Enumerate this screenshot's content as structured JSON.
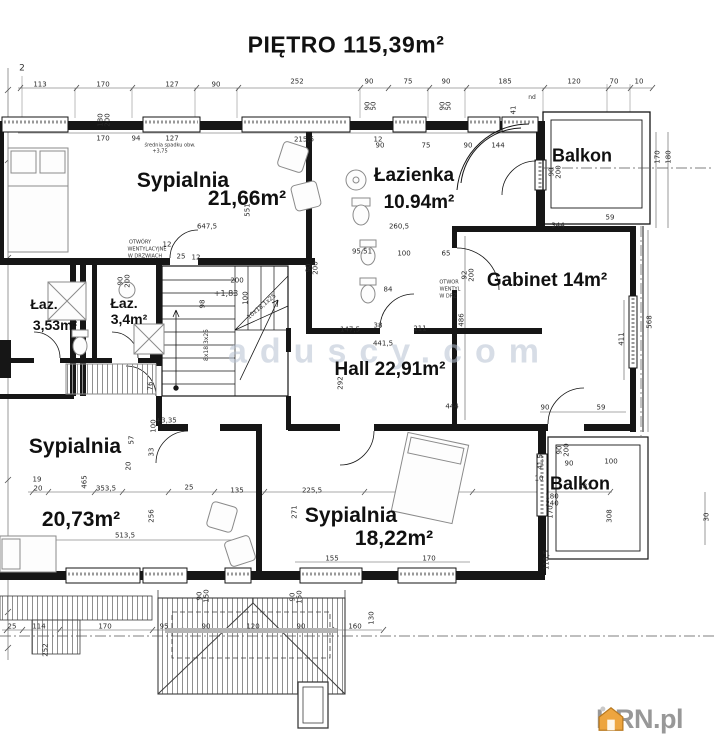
{
  "title": "PIĘTRO 115,39m²",
  "watermark": "aduscy.com",
  "logo": {
    "text": "KRN.pl"
  },
  "colors": {
    "line": "#161616",
    "watermark_blue": "#b7c2d3",
    "logo_orange": "#eda53f",
    "logo_gray": "#989898"
  },
  "room_labels": [
    {
      "id": "sypialnia-1",
      "text": "Sypialnia",
      "x": 183,
      "y": 181,
      "size": 21
    },
    {
      "id": "sypialnia-1-area",
      "text": "21,66m²",
      "x": 247,
      "y": 199,
      "size": 21
    },
    {
      "id": "lazienka",
      "text": "Łazienka",
      "x": 414,
      "y": 176,
      "size": 19
    },
    {
      "id": "lazienka-area",
      "text": "10.94m²",
      "x": 419,
      "y": 203,
      "size": 19
    },
    {
      "id": "balkon-1",
      "text": "Balkon",
      "x": 582,
      "y": 156,
      "size": 18
    },
    {
      "id": "gabinet",
      "text": "Gabinet 14m²",
      "x": 547,
      "y": 281,
      "size": 19
    },
    {
      "id": "laz-1",
      "text": "Łaz.",
      "x": 44,
      "y": 304,
      "size": 14
    },
    {
      "id": "laz-1-area",
      "text": "3,53m²",
      "x": 55,
      "y": 325,
      "size": 14
    },
    {
      "id": "laz-2",
      "text": "Łaz.",
      "x": 124,
      "y": 303,
      "size": 14
    },
    {
      "id": "laz-2-area",
      "text": "3,4m²",
      "x": 129,
      "y": 319,
      "size": 14
    },
    {
      "id": "hall",
      "text": "Hall 22,91m²",
      "x": 390,
      "y": 370,
      "size": 19
    },
    {
      "id": "sypialnia-2",
      "text": "Sypialnia",
      "x": 75,
      "y": 447,
      "size": 21
    },
    {
      "id": "sypialnia-2-area",
      "text": "20,73m²",
      "x": 81,
      "y": 520,
      "size": 21
    },
    {
      "id": "sypialnia-3",
      "text": "Sypialnia",
      "x": 351,
      "y": 516,
      "size": 21
    },
    {
      "id": "sypialnia-3-area",
      "text": "18,22m²",
      "x": 394,
      "y": 539,
      "size": 21
    },
    {
      "id": "balkon-2",
      "text": "Balkon",
      "x": 580,
      "y": 484,
      "size": 18
    }
  ],
  "annotations": [
    {
      "text": "2",
      "x": 22,
      "y": 69,
      "size": 9
    },
    {
      "text": "średnia spadku obw.",
      "x": 170,
      "y": 146,
      "size": 5
    },
    {
      "text": "+3,75",
      "x": 160,
      "y": 152,
      "size": 5
    },
    {
      "text": "OTWÓRY",
      "x": 140,
      "y": 243,
      "size": 5
    },
    {
      "text": "WENTYLACYJNE",
      "x": 147,
      "y": 250,
      "size": 5
    },
    {
      "text": "W DRZWIACH",
      "x": 145,
      "y": 257,
      "size": 5
    },
    {
      "text": "+1,83",
      "x": 226,
      "y": 294,
      "size": 8
    },
    {
      "text": "+3,35",
      "x": 166,
      "y": 421,
      "size": 7
    },
    {
      "text": "OTWOR",
      "x": 449,
      "y": 283,
      "size": 5
    },
    {
      "text": "WENTYL",
      "x": 450,
      "y": 290,
      "size": 5
    },
    {
      "text": "W DRZ",
      "x": 448,
      "y": 297,
      "size": 5
    },
    {
      "text": "10x18,1x25",
      "x": 262,
      "y": 307,
      "size": 6,
      "rot": -40
    },
    {
      "text": "8x18,3x25",
      "x": 207,
      "y": 345,
      "size": 6,
      "rot": -90
    },
    {
      "text": "nd",
      "x": 532,
      "y": 98,
      "size": 6
    }
  ],
  "dimensions": [
    {
      "t": "113",
      "x": 40,
      "y": 85
    },
    {
      "t": "170",
      "x": 103,
      "y": 85
    },
    {
      "t": "127",
      "x": 172,
      "y": 85
    },
    {
      "t": "90",
      "x": 216,
      "y": 85
    },
    {
      "t": "252",
      "x": 297,
      "y": 82
    },
    {
      "t": "90",
      "x": 369,
      "y": 82
    },
    {
      "t": "75",
      "x": 408,
      "y": 82
    },
    {
      "t": "90",
      "x": 446,
      "y": 82
    },
    {
      "t": "185",
      "x": 505,
      "y": 82
    },
    {
      "t": "120",
      "x": 574,
      "y": 82
    },
    {
      "t": "70",
      "x": 614,
      "y": 82
    },
    {
      "t": "10",
      "x": 639,
      "y": 82
    },
    {
      "t": "94",
      "x": 136,
      "y": 139
    },
    {
      "t": "170",
      "x": 103,
      "y": 139
    },
    {
      "t": "127",
      "x": 172,
      "y": 139
    },
    {
      "t": "215,5",
      "x": 304,
      "y": 140
    },
    {
      "t": "12",
      "x": 378,
      "y": 140
    },
    {
      "t": "90",
      "x": 380,
      "y": 146
    },
    {
      "t": "75",
      "x": 426,
      "y": 146
    },
    {
      "t": "90",
      "x": 468,
      "y": 146
    },
    {
      "t": "144",
      "x": 498,
      "y": 146
    },
    {
      "t": "180",
      "x": 101,
      "y": 120,
      "r": -90
    },
    {
      "t": "200",
      "x": 108,
      "y": 120,
      "r": -90
    },
    {
      "t": "90",
      "x": 368,
      "y": 106,
      "r": -90
    },
    {
      "t": "50",
      "x": 374,
      "y": 106,
      "r": -90
    },
    {
      "t": "90",
      "x": 443,
      "y": 106,
      "r": -90
    },
    {
      "t": "50",
      "x": 449,
      "y": 106,
      "r": -90
    },
    {
      "t": "41",
      "x": 514,
      "y": 110,
      "r": -90
    },
    {
      "t": "170",
      "x": 658,
      "y": 157,
      "r": -90
    },
    {
      "t": "180",
      "x": 669,
      "y": 157,
      "r": -90
    },
    {
      "t": "90",
      "x": 552,
      "y": 172,
      "r": -90
    },
    {
      "t": "200",
      "x": 559,
      "y": 172,
      "r": -90
    },
    {
      "t": "344",
      "x": 558,
      "y": 226
    },
    {
      "t": "59",
      "x": 610,
      "y": 218
    },
    {
      "t": "568",
      "x": 650,
      "y": 322,
      "r": -90
    },
    {
      "t": "411",
      "x": 622,
      "y": 339,
      "r": -90
    },
    {
      "t": "486",
      "x": 462,
      "y": 320,
      "r": -90
    },
    {
      "t": "647,5",
      "x": 207,
      "y": 227
    },
    {
      "t": "551",
      "x": 248,
      "y": 210,
      "r": -90
    },
    {
      "t": "12",
      "x": 167,
      "y": 245
    },
    {
      "t": "25",
      "x": 181,
      "y": 257
    },
    {
      "t": "12",
      "x": 196,
      "y": 258
    },
    {
      "t": "200",
      "x": 237,
      "y": 281
    },
    {
      "t": "100",
      "x": 246,
      "y": 298,
      "r": -90
    },
    {
      "t": "98",
      "x": 203,
      "y": 304,
      "r": -90
    },
    {
      "t": "90",
      "x": 121,
      "y": 281,
      "r": -90
    },
    {
      "t": "200",
      "x": 128,
      "y": 281,
      "r": -90
    },
    {
      "t": "76",
      "x": 151,
      "y": 386,
      "r": -90
    },
    {
      "t": "260,5",
      "x": 399,
      "y": 227
    },
    {
      "t": "95.51",
      "x": 362,
      "y": 252
    },
    {
      "t": "100",
      "x": 404,
      "y": 254
    },
    {
      "t": "65",
      "x": 446,
      "y": 254
    },
    {
      "t": "92",
      "x": 465,
      "y": 275,
      "r": -90
    },
    {
      "t": "200",
      "x": 472,
      "y": 275,
      "r": -90
    },
    {
      "t": "84",
      "x": 388,
      "y": 290
    },
    {
      "t": "38",
      "x": 378,
      "y": 326
    },
    {
      "t": "211",
      "x": 420,
      "y": 329
    },
    {
      "t": "90",
      "x": 309,
      "y": 268,
      "r": -90
    },
    {
      "t": "200",
      "x": 316,
      "y": 268,
      "r": -90
    },
    {
      "t": "147,5",
      "x": 350,
      "y": 330
    },
    {
      "t": "441,5",
      "x": 383,
      "y": 344
    },
    {
      "t": "292",
      "x": 341,
      "y": 383,
      "r": -90
    },
    {
      "t": "444",
      "x": 452,
      "y": 407
    },
    {
      "t": "90",
      "x": 545,
      "y": 408
    },
    {
      "t": "59",
      "x": 601,
      "y": 408
    },
    {
      "t": "100",
      "x": 154,
      "y": 426,
      "r": -90
    },
    {
      "t": "57",
      "x": 132,
      "y": 440,
      "r": -90
    },
    {
      "t": "33",
      "x": 152,
      "y": 452,
      "r": -90
    },
    {
      "t": "20",
      "x": 129,
      "y": 466,
      "r": -90
    },
    {
      "t": "19",
      "x": 37,
      "y": 480
    },
    {
      "t": "20",
      "x": 38,
      "y": 489
    },
    {
      "t": "465",
      "x": 85,
      "y": 482,
      "r": -90
    },
    {
      "t": "353,5",
      "x": 106,
      "y": 489
    },
    {
      "t": "25",
      "x": 189,
      "y": 488
    },
    {
      "t": "135",
      "x": 237,
      "y": 491
    },
    {
      "t": "225,5",
      "x": 312,
      "y": 491
    },
    {
      "t": "381",
      "x": 585,
      "y": 487
    },
    {
      "t": "256",
      "x": 152,
      "y": 516,
      "r": -90
    },
    {
      "t": "271",
      "x": 295,
      "y": 512,
      "r": -90
    },
    {
      "t": "41,5",
      "x": 541,
      "y": 462,
      "r": -90
    },
    {
      "t": "90",
      "x": 569,
      "y": 464
    },
    {
      "t": "100",
      "x": 611,
      "y": 462
    },
    {
      "t": "10",
      "x": 539,
      "y": 479
    },
    {
      "t": "180",
      "x": 552,
      "y": 497
    },
    {
      "t": "240",
      "x": 552,
      "y": 504
    },
    {
      "t": "170",
      "x": 551,
      "y": 512,
      "r": -90
    },
    {
      "t": "308",
      "x": 610,
      "y": 516,
      "r": -90
    },
    {
      "t": "30",
      "x": 707,
      "y": 517,
      "r": -90
    },
    {
      "t": "90",
      "x": 560,
      "y": 450,
      "r": -90
    },
    {
      "t": "200",
      "x": 567,
      "y": 450,
      "r": -90
    },
    {
      "t": "513,5",
      "x": 125,
      "y": 536
    },
    {
      "t": "155",
      "x": 332,
      "y": 559
    },
    {
      "t": "170",
      "x": 429,
      "y": 559
    },
    {
      "t": "118,5",
      "x": 547,
      "y": 560,
      "r": -90
    },
    {
      "t": "90",
      "x": 200,
      "y": 596,
      "r": -90
    },
    {
      "t": "150",
      "x": 207,
      "y": 596,
      "r": -90
    },
    {
      "t": "90",
      "x": 293,
      "y": 597,
      "r": -90
    },
    {
      "t": "150",
      "x": 300,
      "y": 597,
      "r": -90
    },
    {
      "t": "25",
      "x": 12,
      "y": 627
    },
    {
      "t": "114",
      "x": 39,
      "y": 627
    },
    {
      "t": "170",
      "x": 105,
      "y": 627
    },
    {
      "t": "95",
      "x": 164,
      "y": 627
    },
    {
      "t": "90",
      "x": 206,
      "y": 627
    },
    {
      "t": "120",
      "x": 253,
      "y": 627
    },
    {
      "t": "90",
      "x": 301,
      "y": 627
    },
    {
      "t": "160",
      "x": 355,
      "y": 627
    },
    {
      "t": "130",
      "x": 372,
      "y": 618,
      "r": -90
    },
    {
      "t": "252",
      "x": 46,
      "y": 650,
      "r": -90
    }
  ]
}
